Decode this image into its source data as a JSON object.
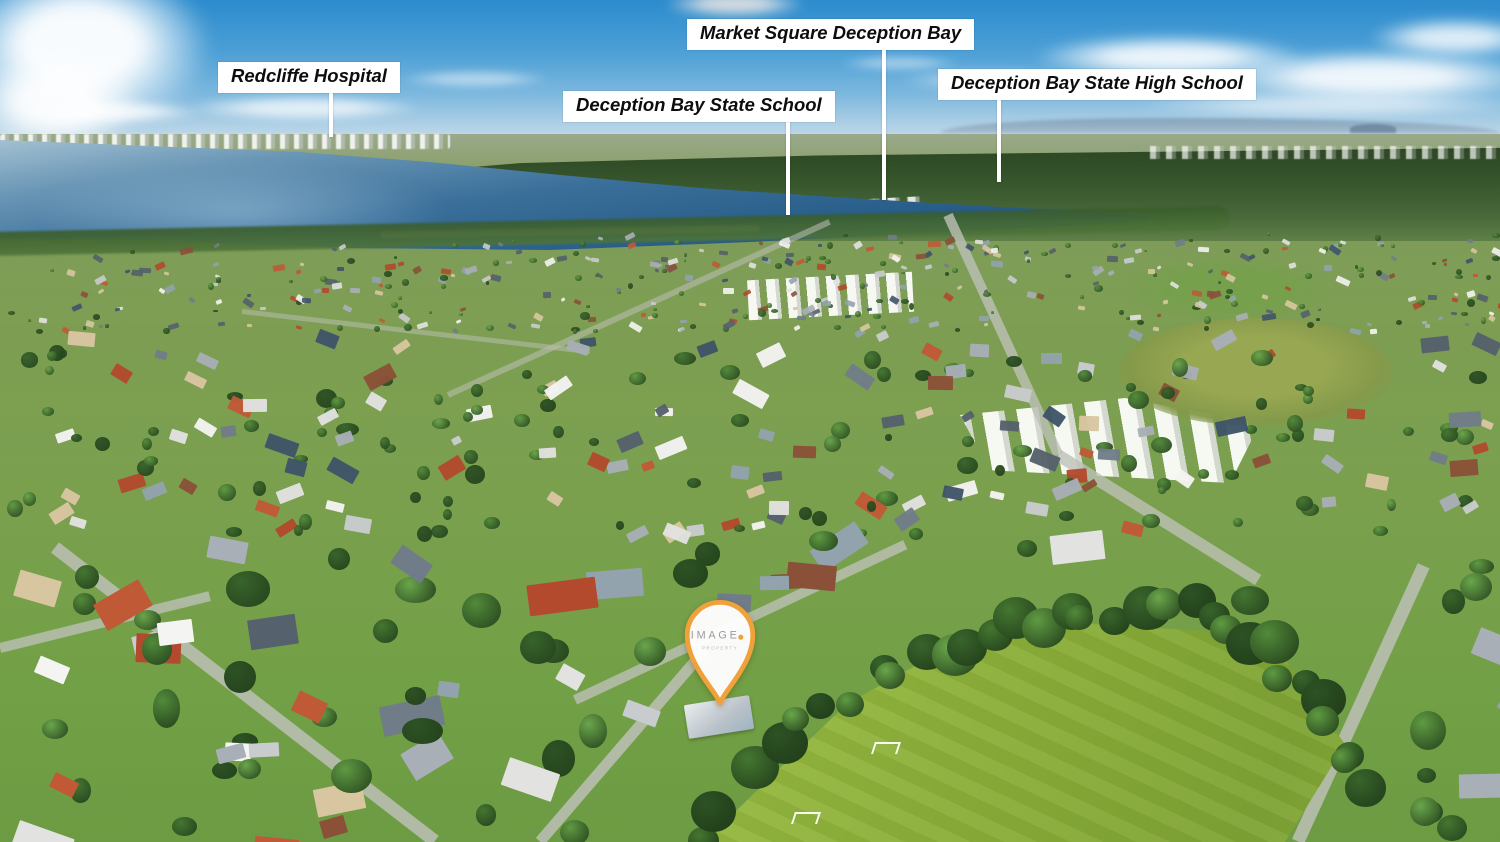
{
  "photo": {
    "scene_description": "Aerial drone photograph over a Deception Bay residential suburb with Moreton Bay water at upper left, distant Redcliffe skyline on the horizon, dense housing in the midground and a bright green sports field at lower right",
    "colors": {
      "sky_top": "#2c8bcd",
      "sky_horizon": "#d6e6ef",
      "water_deep": "#1d4f78",
      "water_light": "#8fb3c9",
      "mangrove_forest": "#33532a",
      "suburb_green": "#7da050",
      "field_green": "#8db03a",
      "road_gray": "#bdc0b6",
      "label_background": "#ffffff",
      "label_text": "#0d0d0d",
      "marker_orange": "#f0a13a",
      "marker_brand_gray": "#9a9a98"
    }
  },
  "annotations": [
    {
      "label": "Redcliffe Hospital"
    },
    {
      "label": "Market Square Deception Bay"
    },
    {
      "label": "Deception Bay State School"
    },
    {
      "label": "Deception Bay State High School"
    }
  ],
  "marker": {
    "brand": "IMAGE",
    "subtitle": "PROPERTY"
  }
}
